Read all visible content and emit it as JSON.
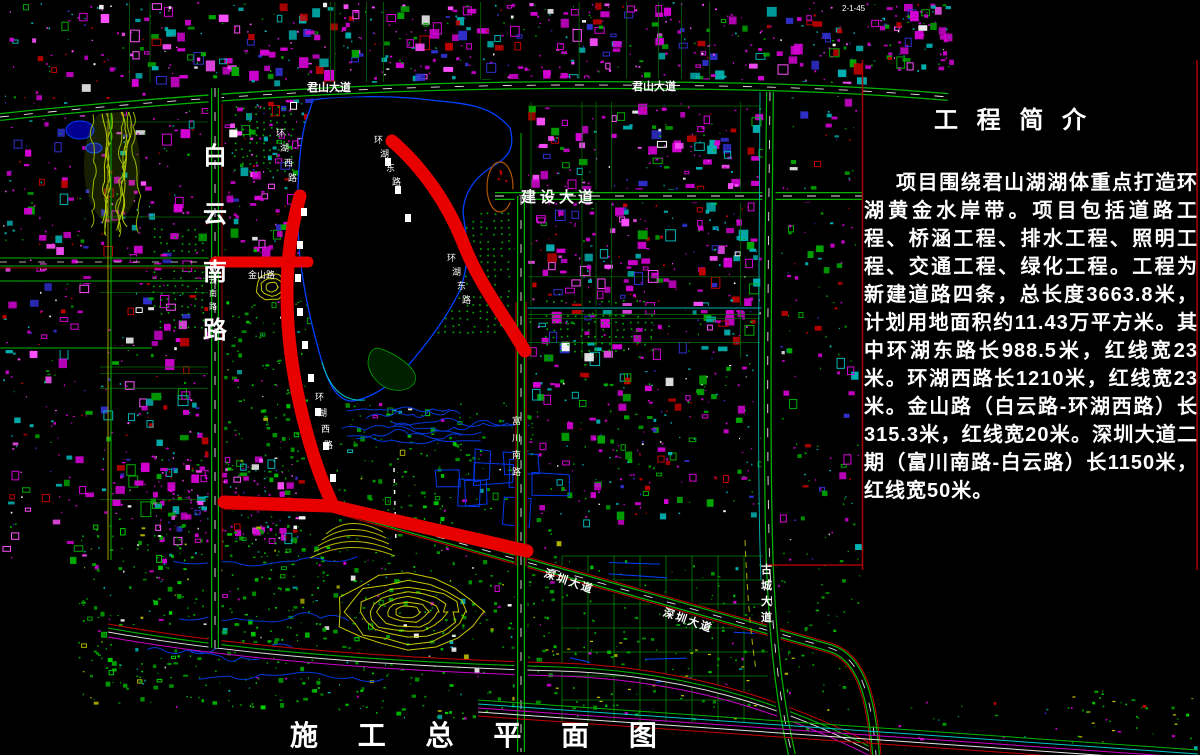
{
  "panel": {
    "title": "工 程 简 介",
    "body": "项目围绕君山湖湖体重点打造环湖黄金水岸带。项目包括道路工程、桥涵工程、排水工程、照明工程、交通工程、绿化工程。工程为新建道路四条，总长度3663.8米，计划用地面积约11.43万平方米。其中环湖东路长988.5米，红线宽23米。环湖西路长1210米，红线宽23米。金山路（白云路-环湖西路）长315.3米，红线宽20米。深圳大道二期（富川南路-白云路）长1150米，红线宽50米。"
  },
  "footer": {
    "title": "施 工 总 平 面 图"
  },
  "colors": {
    "background": "#000000",
    "road_green": "#00b400",
    "highlight_red": "#e80000",
    "thin_red": "#c80000",
    "water_blue": "#0040ff",
    "contour_yellow": "#c8c800",
    "building_magenta": "#d400d4",
    "cyan": "#00b4b4",
    "text_white": "#ffffff"
  },
  "map": {
    "red_routes": [
      {
        "name": "环湖东路",
        "d": "M392,141 C423,168 447,203 462,240 C474,272 492,299 509,325 L525,351",
        "width": 13
      },
      {
        "name": "环湖西路",
        "d": "M300,196 C286,245 284,300 291,355 C297,400 311,458 331,501",
        "width": 13
      },
      {
        "name": "深圳大道二期",
        "d": "M224,502 L332,506 L527,551",
        "width": 13
      },
      {
        "name": "金山路",
        "d": "M215,262 L308,262",
        "width": 11
      }
    ],
    "roads": {
      "junshan_avenue": "M0,117 C180,98 360,86 560,85 C700,85 820,86 948,97",
      "baiyun_south": "M215,88 L215,648",
      "jianshe_avenue": "M495,196 L862,196",
      "fuchuan_south": "M521,196 L521,752",
      "fuchuan_upper": "M521,133 L521,196",
      "fuchuan_redpair": "M521,302 L521,566",
      "gucheng_avenue": "M770,92 C768,280 766,460 770,570 C774,660 782,712 792,755",
      "shenzhen_avenue": "M224,504 L332,507 L830,648 C862,658 872,700 876,755",
      "jinshan_upper": "M0,258 L312,258",
      "jinshan_lower": "M0,266 L312,266",
      "jinshan_center": "M0,262 L312,262",
      "jinshan_redline": "M0,268 L215,268",
      "street_281": "M0,281 L215,281",
      "street_348": "M0,348 L152,348",
      "street_x108a": "M108,112 L108,560",
      "street_x108b": "M111,112 L111,560",
      "street_x222red": "M222,92 L222,560",
      "cross_308": "M521,308 L762,308",
      "gucheng_cyan": "M760,92 C759,300 757,480 761,580",
      "yellow_path": "M745,540 C747,590 750,630 756,670",
      "bottom_curve": "M108,628 C230,650 380,662 560,667 C680,671 780,700 880,752",
      "white_trail": "M394,468 L396,545"
    },
    "frame_lines": [
      {
        "d": "M862.5,60 L862.5,570",
        "color": "#aa0000",
        "w": 1.5
      },
      {
        "d": "M1197,60 L1197,570",
        "color": "#aa0000",
        "w": 1.5
      },
      {
        "d": "M768,565 L862,565",
        "color": "#c80000",
        "w": 1.2
      }
    ],
    "footer_bundle": {
      "x1": 478,
      "y1": 700,
      "x2": 1198,
      "y2": 750,
      "colors": [
        "#00b400",
        "#00c8c8",
        "#cc00cc",
        "#e8e8e8",
        "#c80000"
      ]
    },
    "lake": {
      "d": "M313,100 C340,95 400,96 430,100 C470,104 492,106 510,128 C516,150 507,158 490,168 C472,180 464,195 463,212 C466,238 472,256 460,290 C445,322 420,352 400,375 C382,392 362,401 350,401 C336,399 328,382 322,362 C314,335 305,300 300,258 C296,215 297,158 305,124 Z",
      "fill": "#000000",
      "stroke": "#0040ff"
    },
    "stadium": {
      "cx": 500,
      "cy": 187,
      "rx": 13,
      "ry": 25,
      "stroke": "#b05500"
    },
    "labels": [
      {
        "text": "白云南路",
        "x": 203,
        "y": 140,
        "vertical": true,
        "step": 58,
        "size": 24,
        "bold": true
      },
      {
        "text": "白云南路",
        "x": 209,
        "y": 262,
        "vertical": true,
        "step": 13,
        "size": 8
      },
      {
        "text": "君山大道",
        "x": 307,
        "y": 80,
        "size": 11,
        "bold": true
      },
      {
        "text": "君山大道",
        "x": 632,
        "y": 79,
        "size": 11,
        "bold": true
      },
      {
        "text": "建设大道",
        "x": 521,
        "y": 187,
        "size": 15,
        "ls": 4,
        "bold": true
      },
      {
        "text": "环湖西路",
        "x": 276,
        "y": 127,
        "vertical": true,
        "step": 15,
        "drift": 4,
        "size": 9
      },
      {
        "text": "环湖西路",
        "x": 315,
        "y": 391,
        "vertical": true,
        "step": 16,
        "drift": 3,
        "size": 9
      },
      {
        "text": "环湖东路",
        "x": 374,
        "y": 134,
        "vertical": true,
        "step": 14,
        "drift": 6,
        "size": 9
      },
      {
        "text": "环湖东路",
        "x": 447,
        "y": 252,
        "vertical": true,
        "step": 14,
        "drift": 5,
        "size": 9
      },
      {
        "text": "富川南路",
        "x": 512,
        "y": 415,
        "vertical": true,
        "step": 17,
        "size": 9
      },
      {
        "text": "金山路",
        "x": 248,
        "y": 269,
        "size": 9
      },
      {
        "text": "深圳大道",
        "x": 547,
        "y": 566,
        "size": 11,
        "rotate": 19,
        "ls": 2,
        "bold": true
      },
      {
        "text": "深圳大道",
        "x": 666,
        "y": 605,
        "size": 11,
        "rotate": 19,
        "ls": 2,
        "bold": true
      },
      {
        "text": "古城大道",
        "x": 761,
        "y": 562,
        "vertical": true,
        "step": 16,
        "size": 11,
        "bold": true
      },
      {
        "text": "2-1-45",
        "x": 842,
        "y": 3,
        "size": 8
      }
    ]
  }
}
